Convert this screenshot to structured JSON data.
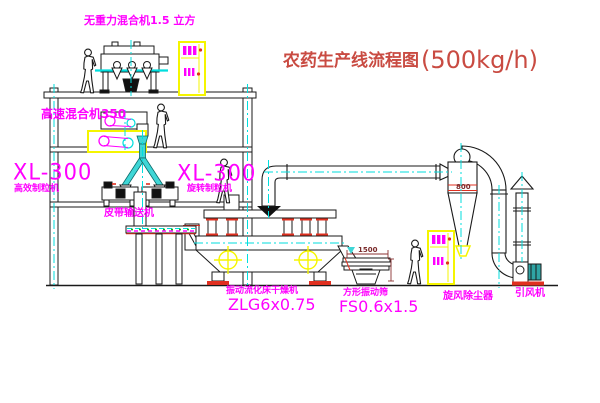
{
  "title": {
    "main": "农药生产线流程图",
    "capacity": "(500kg/h)"
  },
  "equipment_labels": {
    "gravity_free_mixer": "无重力混合机1.5 立方",
    "high_speed_mixer": "高速混合机350",
    "granulator_left": {
      "model": "XL-300",
      "name": "高效制粒机"
    },
    "granulator_right": {
      "model": "XL-300",
      "name": "旋转制粒机"
    },
    "belt_conveyor": "皮带输送机",
    "fluid_bed_dryer": {
      "name": "振动流化床干燥机",
      "model": "ZLG6x0.75"
    },
    "vibrating_screen": {
      "name": "方形振动筛",
      "model": "FS0.6x1.5"
    },
    "cyclone": "旋风除尘器",
    "induced_draft_fan": "引风机"
  },
  "dimensions": {
    "cyclone_band": "800",
    "screen_width": "1500"
  },
  "colors": {
    "label_magenta": "#ff00ff",
    "title_red": "#c94b42",
    "centerline_cyan": "#00dede",
    "equipment_yellow": "#f5f500",
    "accent_red": "#e03020",
    "accent_green": "#00aa00",
    "motor_teal": "#2fa3a3",
    "line_black": "#1a1a1a",
    "background": "#ffffff"
  }
}
